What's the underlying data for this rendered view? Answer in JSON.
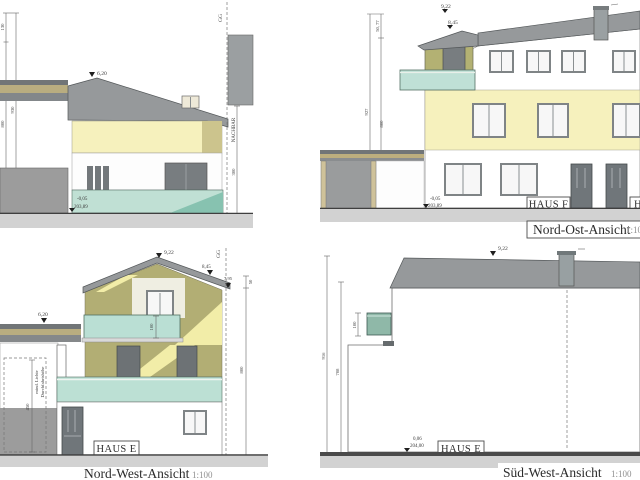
{
  "sheet": {
    "colors": {
      "roof_gray": "#96999b",
      "facade_olive": "#b2ae74",
      "facade_yellow": "#f6f1bd",
      "plinth_teal": "#c0e0d4",
      "balcony_teal": "#8fb8a8",
      "ground_gray": "#d2d2d2",
      "window_dark": "#6d7275",
      "wood_tan": "#bcae7e"
    }
  },
  "view_top_left": {
    "ridge_level": "6,20",
    "dim_upper": "130",
    "dim_total": "930",
    "dim_wall": "800",
    "boundary_label": "GG",
    "neighbor_label": "NACHBAR",
    "neighbor_dim": "300",
    "level_relative": "-0,05",
    "level_absolute": "203,89"
  },
  "view_nord_ost": {
    "title": "Nord-Ost-Ansicht",
    "scale": "1:100",
    "house_label": "HAUS F",
    "house_label_cut": "H",
    "ridge_level": "9,22",
    "dormer_level": "8,45",
    "dim_top": "50, 77",
    "dim_total": "927",
    "dim_wall": "800",
    "level_relative": "-0,05",
    "level_absolute": "203,89"
  },
  "view_nord_west": {
    "title": "Nord-West-Ansicht",
    "scale": "1:100",
    "house_label": "HAUS E",
    "ridge_level": "9,22",
    "eave_level": "8,45",
    "eave_lower_level": "7,95",
    "dim_eave": "50",
    "carport_level": "6,20",
    "balcony_height": "100",
    "dim_wall": "800",
    "boundary_label": "GG",
    "clearance_label_1": "mind. Lichte",
    "clearance_label_2": "Durchfahrtshöhe",
    "clearance_dim": "450"
  },
  "view_sued_west": {
    "title": "Süd-West-Ansicht",
    "scale": "1:100",
    "house_label": "HAUS E",
    "ridge_level": "9,22",
    "balcony_height": "100",
    "dim_total": "916",
    "dim_wall": "708",
    "level_relative": "0,06",
    "level_absolute": "204,00"
  }
}
